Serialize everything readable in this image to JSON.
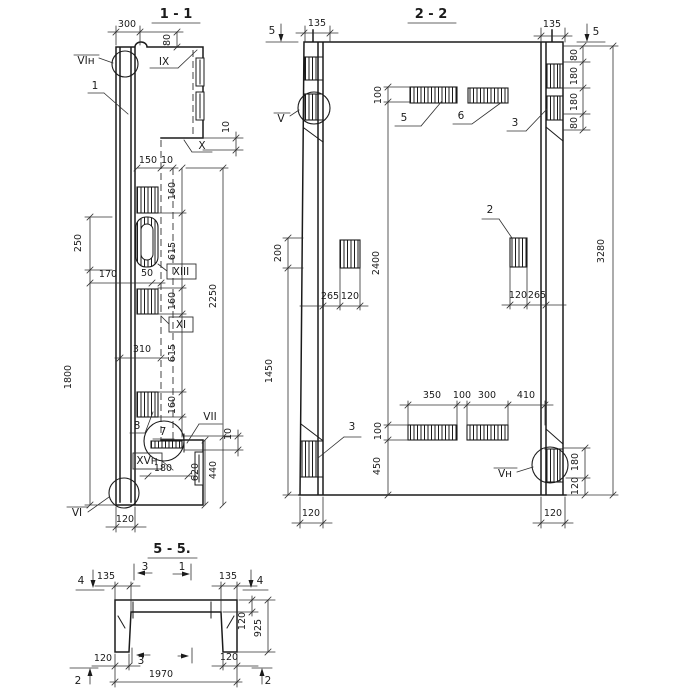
{
  "drawing": {
    "ink": "#1b1b1b",
    "paper": "#ffffff",
    "sections": [
      {
        "id": "1-1",
        "title": "1 - 1"
      },
      {
        "id": "2-2",
        "title": "2 - 2"
      },
      {
        "id": "5-5",
        "title": "5 - 5."
      }
    ],
    "labels": [
      {
        "n": "dim-300",
        "t": "300",
        "x": 127,
        "y": 27
      },
      {
        "n": "dim-80",
        "t": "80",
        "x": 170,
        "y": 40,
        "r": -90
      },
      {
        "n": "callout-vi-n-top",
        "t": "VIн",
        "x": 86,
        "y": 64,
        "c": "md"
      },
      {
        "n": "pos-1",
        "t": "1",
        "x": 95,
        "y": 89,
        "c": "md"
      },
      {
        "n": "callout-ix",
        "t": "IX",
        "x": 164,
        "y": 65,
        "c": "md"
      },
      {
        "n": "callout-x",
        "t": "X",
        "x": 202,
        "y": 149,
        "c": "md"
      },
      {
        "n": "dim-10-top",
        "t": "10",
        "x": 229,
        "y": 127,
        "r": -90
      },
      {
        "n": "dim-150",
        "t": "150",
        "x": 148,
        "y": 163
      },
      {
        "n": "dim-10-step",
        "t": "10",
        "x": 167,
        "y": 163
      },
      {
        "n": "dim-160-1",
        "t": "160",
        "x": 175,
        "y": 191,
        "r": -90
      },
      {
        "n": "dim-615-1",
        "t": "615",
        "x": 175,
        "y": 251,
        "r": -90
      },
      {
        "n": "dim-160-2",
        "t": "160",
        "x": 175,
        "y": 301,
        "r": -90
      },
      {
        "n": "dim-615-2",
        "t": "615",
        "x": 175,
        "y": 353,
        "r": -90
      },
      {
        "n": "dim-160-3",
        "t": "160",
        "x": 175,
        "y": 405,
        "r": -90
      },
      {
        "n": "dim-2250",
        "t": "2250",
        "x": 216,
        "y": 296,
        "r": -90
      },
      {
        "n": "dim-440",
        "t": "440",
        "x": 216,
        "y": 470,
        "r": -90
      },
      {
        "n": "dim-620",
        "t": "620",
        "x": 198,
        "y": 472,
        "r": -90
      },
      {
        "n": "dim-250",
        "t": "250",
        "x": 81,
        "y": 243,
        "r": -90
      },
      {
        "n": "dim-1800",
        "t": "1800",
        "x": 71,
        "y": 377,
        "r": -90
      },
      {
        "n": "dim-170",
        "t": "170",
        "x": 108,
        "y": 277
      },
      {
        "n": "dim-50",
        "t": "50",
        "x": 147,
        "y": 276
      },
      {
        "n": "callout-xiii",
        "t": "XIII",
        "x": 181,
        "y": 275,
        "c": "md"
      },
      {
        "n": "callout-xi",
        "t": "XI",
        "x": 181,
        "y": 328,
        "c": "md"
      },
      {
        "n": "dim-310",
        "t": "310",
        "x": 142,
        "y": 352
      },
      {
        "n": "pos-8",
        "t": "8",
        "x": 137,
        "y": 429,
        "c": "md"
      },
      {
        "n": "pos-7",
        "t": "7",
        "x": 163,
        "y": 435,
        "c": "md"
      },
      {
        "n": "callout-vii",
        "t": "VII",
        "x": 210,
        "y": 420,
        "c": "md"
      },
      {
        "n": "dim-10-console",
        "t": "10",
        "x": 231,
        "y": 434,
        "r": -90
      },
      {
        "n": "callout-xv-n",
        "t": "XVн",
        "x": 147,
        "y": 464,
        "c": "md"
      },
      {
        "n": "dim-180-s11",
        "t": "180",
        "x": 163,
        "y": 471
      },
      {
        "n": "callout-vi",
        "t": "VI",
        "x": 77,
        "y": 516,
        "c": "md"
      },
      {
        "n": "dim-120-s11",
        "t": "120",
        "x": 125,
        "y": 522
      },
      {
        "n": "marker-5-left",
        "t": "5",
        "x": 272,
        "y": 34,
        "c": "md"
      },
      {
        "n": "dim-135-left",
        "t": "135",
        "x": 317,
        "y": 26
      },
      {
        "n": "dim-135-right",
        "t": "135",
        "x": 552,
        "y": 27
      },
      {
        "n": "marker-5-right",
        "t": "5",
        "x": 596,
        "y": 35,
        "c": "md"
      },
      {
        "n": "dim-80-tr1",
        "t": "80",
        "x": 577,
        "y": 55,
        "r": -90
      },
      {
        "n": "dim-180-tr1",
        "t": "180",
        "x": 577,
        "y": 76,
        "r": -90
      },
      {
        "n": "dim-180-tr2",
        "t": "180",
        "x": 577,
        "y": 102,
        "r": -90
      },
      {
        "n": "dim-80-tr2",
        "t": "80",
        "x": 577,
        "y": 123,
        "r": -90
      },
      {
        "n": "dim-3280",
        "t": "3280",
        "x": 604,
        "y": 251,
        "r": -90
      },
      {
        "n": "callout-v",
        "t": "V",
        "x": 281,
        "y": 122,
        "c": "md"
      },
      {
        "n": "dim-100-top",
        "t": "100",
        "x": 381,
        "y": 95,
        "r": -90
      },
      {
        "n": "pos-5",
        "t": "5",
        "x": 404,
        "y": 121,
        "c": "md"
      },
      {
        "n": "pos-6",
        "t": "6",
        "x": 461,
        "y": 119,
        "c": "md"
      },
      {
        "n": "pos-3-top",
        "t": "3",
        "x": 515,
        "y": 126,
        "c": "md"
      },
      {
        "n": "dim-2400",
        "t": "2400",
        "x": 379,
        "y": 263,
        "r": -90
      },
      {
        "n": "dim-200",
        "t": "200",
        "x": 281,
        "y": 253,
        "r": -90
      },
      {
        "n": "dim-1450",
        "t": "1450",
        "x": 272,
        "y": 371,
        "r": -90
      },
      {
        "n": "dim-265-ml",
        "t": "265",
        "x": 330,
        "y": 299
      },
      {
        "n": "dim-120-ml",
        "t": "120",
        "x": 350,
        "y": 299
      },
      {
        "n": "pos-2",
        "t": "2",
        "x": 490,
        "y": 213,
        "c": "md"
      },
      {
        "n": "dim-120-mr",
        "t": "120",
        "x": 518,
        "y": 298
      },
      {
        "n": "dim-265-mr",
        "t": "265",
        "x": 537,
        "y": 298
      },
      {
        "n": "dim-350",
        "t": "350",
        "x": 432,
        "y": 398
      },
      {
        "n": "dim-100-b",
        "t": "100",
        "x": 462,
        "y": 398
      },
      {
        "n": "dim-300-b",
        "t": "300",
        "x": 487,
        "y": 398
      },
      {
        "n": "dim-410",
        "t": "410",
        "x": 526,
        "y": 398
      },
      {
        "n": "dim-100-bl",
        "t": "100",
        "x": 381,
        "y": 431,
        "r": -90
      },
      {
        "n": "dim-450",
        "t": "450",
        "x": 380,
        "y": 466,
        "r": -90
      },
      {
        "n": "pos-3-bottom",
        "t": "3",
        "x": 352,
        "y": 430,
        "c": "md"
      },
      {
        "n": "callout-v-n",
        "t": "Vн",
        "x": 505,
        "y": 477,
        "c": "md"
      },
      {
        "n": "dim-180-br",
        "t": "180",
        "x": 578,
        "y": 462,
        "r": -90
      },
      {
        "n": "dim-120-br",
        "t": "120",
        "x": 578,
        "y": 486,
        "r": -90
      },
      {
        "n": "dim-120-bl-col",
        "t": "120",
        "x": 311,
        "y": 516
      },
      {
        "n": "dim-120-br-col",
        "t": "120",
        "x": 553,
        "y": 516
      },
      {
        "n": "marker-4-left",
        "t": "4",
        "x": 81,
        "y": 584,
        "c": "md"
      },
      {
        "n": "dim-135-s55-l",
        "t": "135",
        "x": 106,
        "y": 579
      },
      {
        "n": "marker-3-top",
        "t": "3",
        "x": 145,
        "y": 570,
        "c": "md"
      },
      {
        "n": "marker-1-top",
        "t": "1",
        "x": 182,
        "y": 570,
        "c": "md"
      },
      {
        "n": "dim-135-s55-r",
        "t": "135",
        "x": 228,
        "y": 579
      },
      {
        "n": "marker-4-right",
        "t": "4",
        "x": 260,
        "y": 584,
        "c": "md"
      },
      {
        "n": "dim-120-slab",
        "t": "120",
        "x": 245,
        "y": 621,
        "r": -90
      },
      {
        "n": "dim-925",
        "t": "925",
        "x": 261,
        "y": 628,
        "r": -90
      },
      {
        "n": "dim-120-leg-l",
        "t": "120",
        "x": 103,
        "y": 661
      },
      {
        "n": "marker-3-bottom",
        "t": "3",
        "x": 141,
        "y": 664,
        "c": "md"
      },
      {
        "n": "dim-120-leg-r",
        "t": "120",
        "x": 229,
        "y": 660
      },
      {
        "n": "marker-2-left",
        "t": "2",
        "x": 78,
        "y": 684,
        "c": "md"
      },
      {
        "n": "dim-1970",
        "t": "1970",
        "x": 161,
        "y": 677
      },
      {
        "n": "marker-2-right",
        "t": "2",
        "x": 268,
        "y": 684,
        "c": "md"
      }
    ]
  }
}
